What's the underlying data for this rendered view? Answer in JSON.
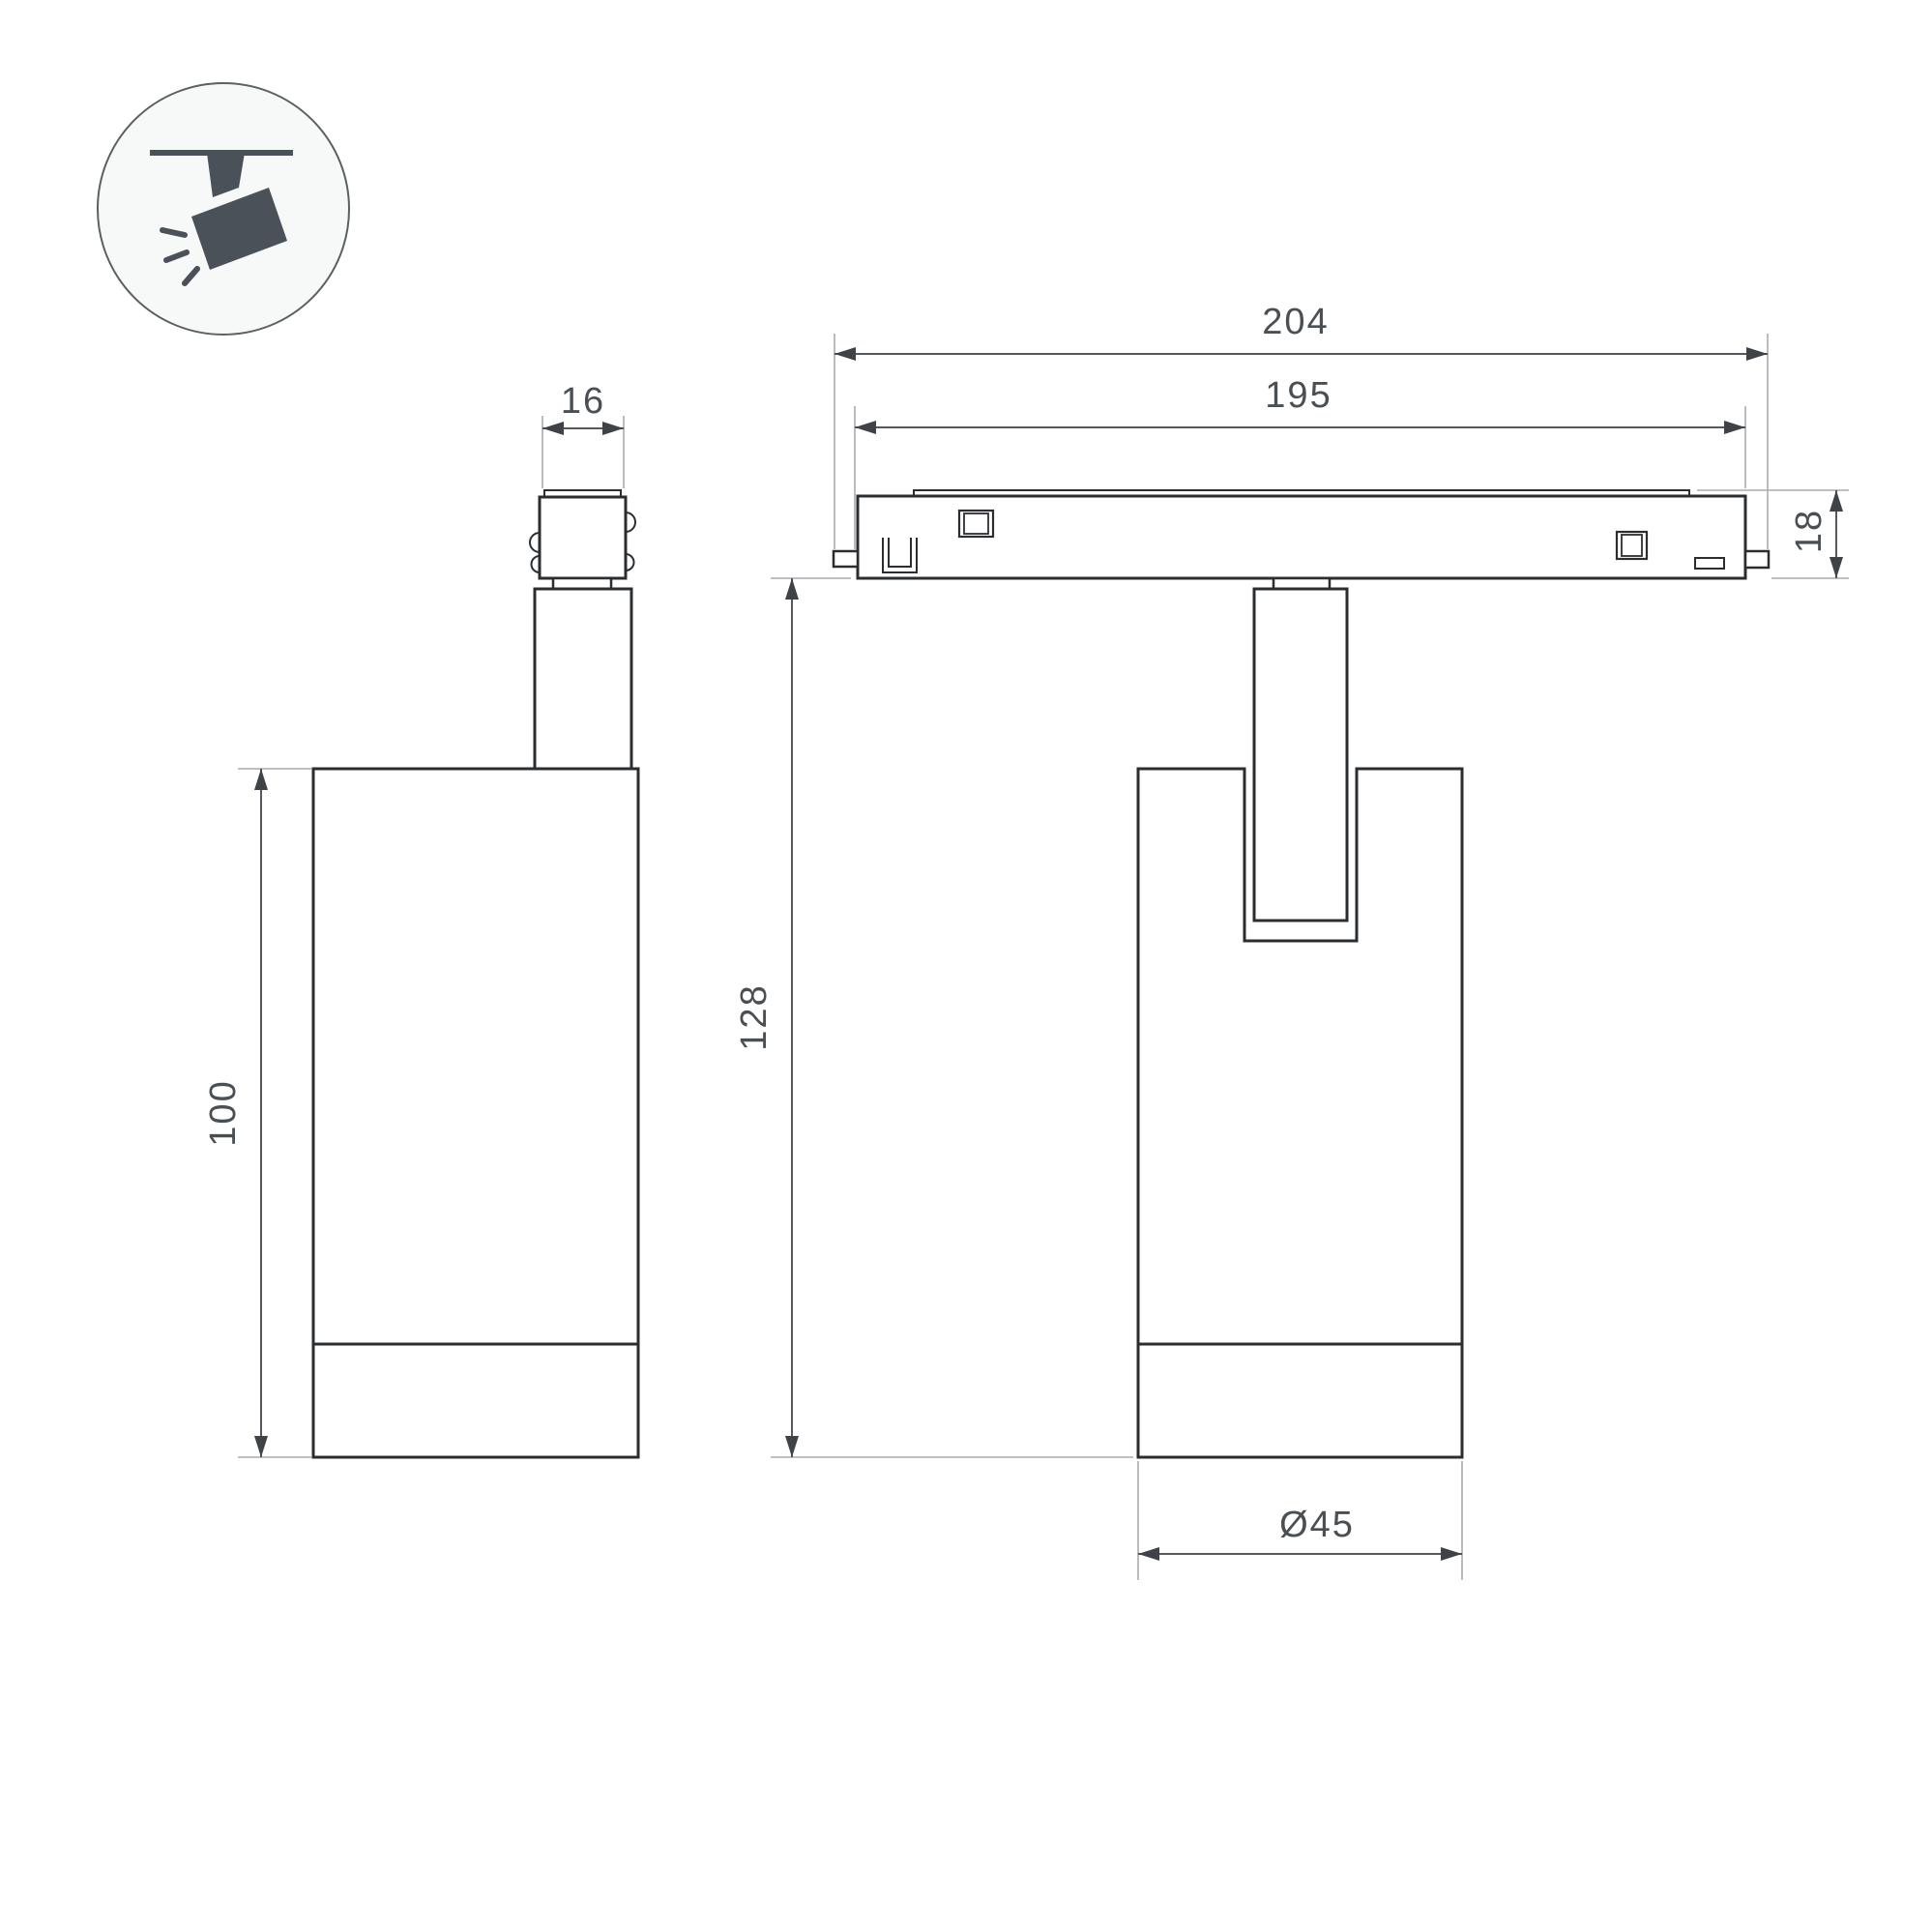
{
  "title": "Magnetic track spotlight — dimension drawing",
  "colors": {
    "background": "#ffffff",
    "outline": "#2b2e31",
    "dimension_line": "#55595d",
    "arrow": "#3f4347",
    "extension_line": "#a8acaf",
    "text": "#4a4f54",
    "icon": "#4a5158",
    "icon_circle_fill": "#f7f8f8",
    "icon_circle_stroke": "#5b6065"
  },
  "icon": {
    "meaning": "ceiling-track-spotlight-pictogram"
  },
  "views": {
    "side": {
      "dimensions": {
        "adapter_width": "16",
        "body_height": "100"
      }
    },
    "front": {
      "dimensions": {
        "overall_length": "204",
        "track_length": "195",
        "track_height": "18",
        "overall_height": "128",
        "body_diameter": "Ø45"
      }
    }
  }
}
